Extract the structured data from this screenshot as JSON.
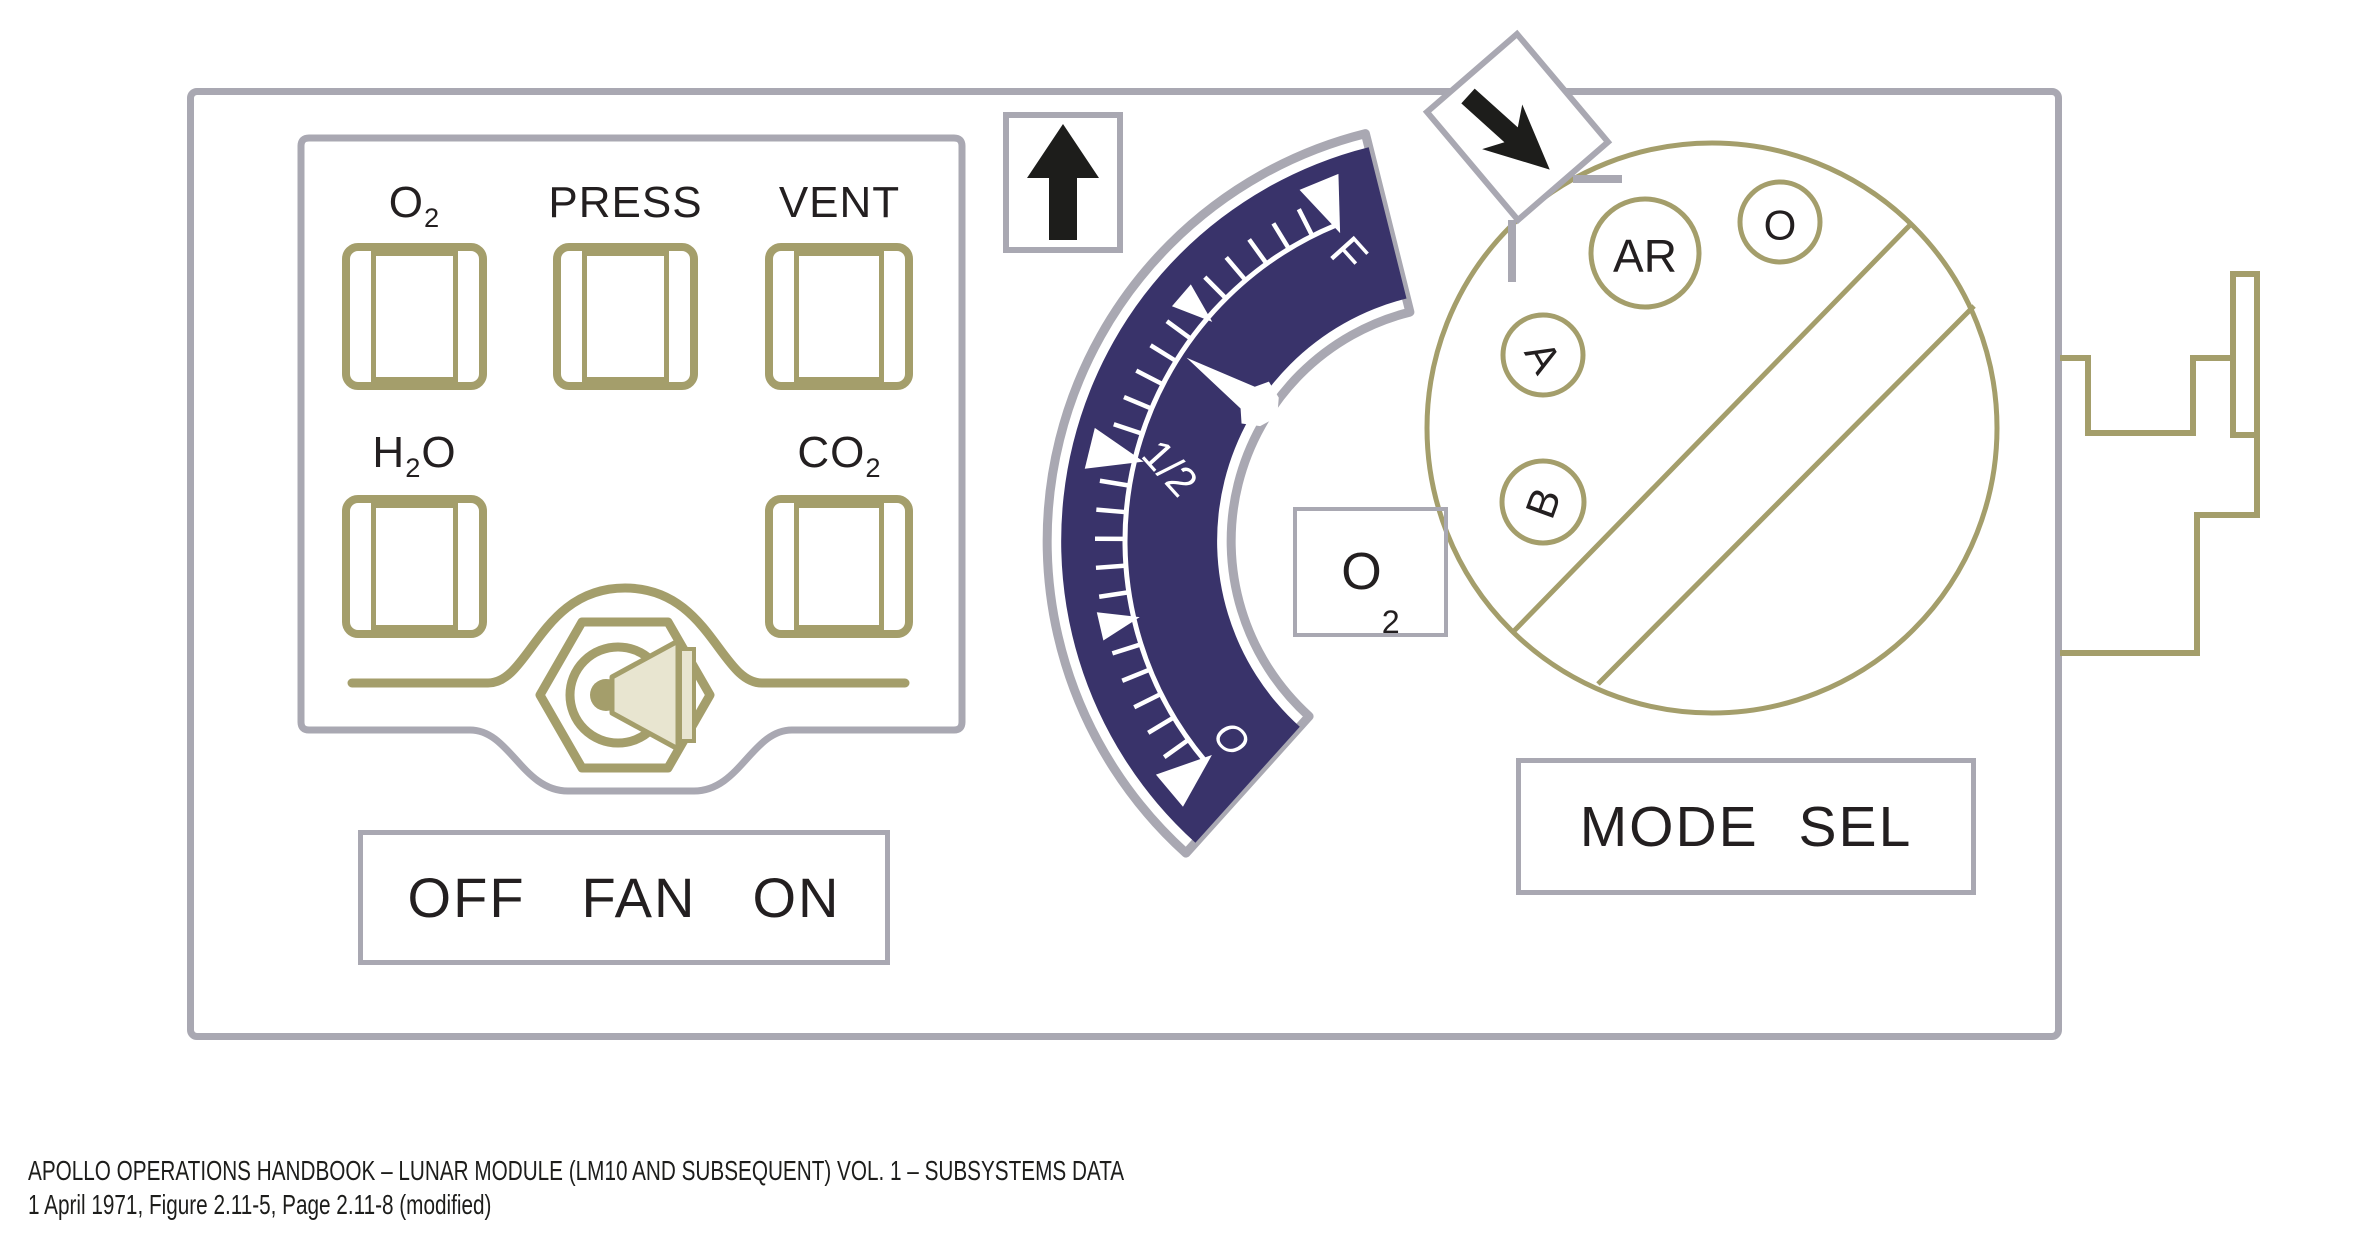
{
  "colors": {
    "olive": "#a49e6b",
    "navy": "#39336a",
    "panel_gray": "#a9a8b2",
    "ink": "#231f20",
    "beige": "#e8e5d0"
  },
  "switch_panel": {
    "switches": [
      {
        "id": "o2",
        "label": {
          "pre": "O",
          "sub": "2",
          "post": ""
        }
      },
      {
        "id": "press",
        "label": {
          "pre": "PRESS",
          "sub": "",
          "post": ""
        }
      },
      {
        "id": "vent",
        "label": {
          "pre": "VENT",
          "sub": "",
          "post": ""
        }
      },
      {
        "id": "h2o",
        "label": {
          "pre": "H",
          "sub": "2",
          "post": "O"
        }
      },
      {
        "id": "co2",
        "label": {
          "pre": "CO",
          "sub": "2",
          "post": ""
        }
      }
    ],
    "fan_label": {
      "off": "OFF",
      "center": "FAN",
      "on": "ON"
    }
  },
  "gauge": {
    "tag": {
      "pre": "O",
      "sub": "2"
    },
    "pointer_fraction": 0.68,
    "labels": [
      {
        "text": "F",
        "fraction": 1
      },
      {
        "text": "1/2",
        "fraction": 0.5
      },
      {
        "text": "O",
        "fraction": 0
      }
    ],
    "major_fractions": [
      0,
      0.5,
      1
    ],
    "medium_fractions": [
      0.25,
      0.75
    ],
    "minors_per_quarter": 5
  },
  "mode_knob": {
    "tag": "MODE SEL",
    "positions": [
      {
        "label": "AR"
      },
      {
        "label": "O"
      },
      {
        "label": "A"
      },
      {
        "label": "B"
      }
    ]
  },
  "caption": {
    "line1": "APOLLO OPERATIONS HANDBOOK – LUNAR MODULE (LM10 AND SUBSEQUENT) VOL. 1 – SUBSYSTEMS DATA",
    "line2": "1 April 1971, Figure 2.11-5, Page 2.11-8 (modified)"
  }
}
